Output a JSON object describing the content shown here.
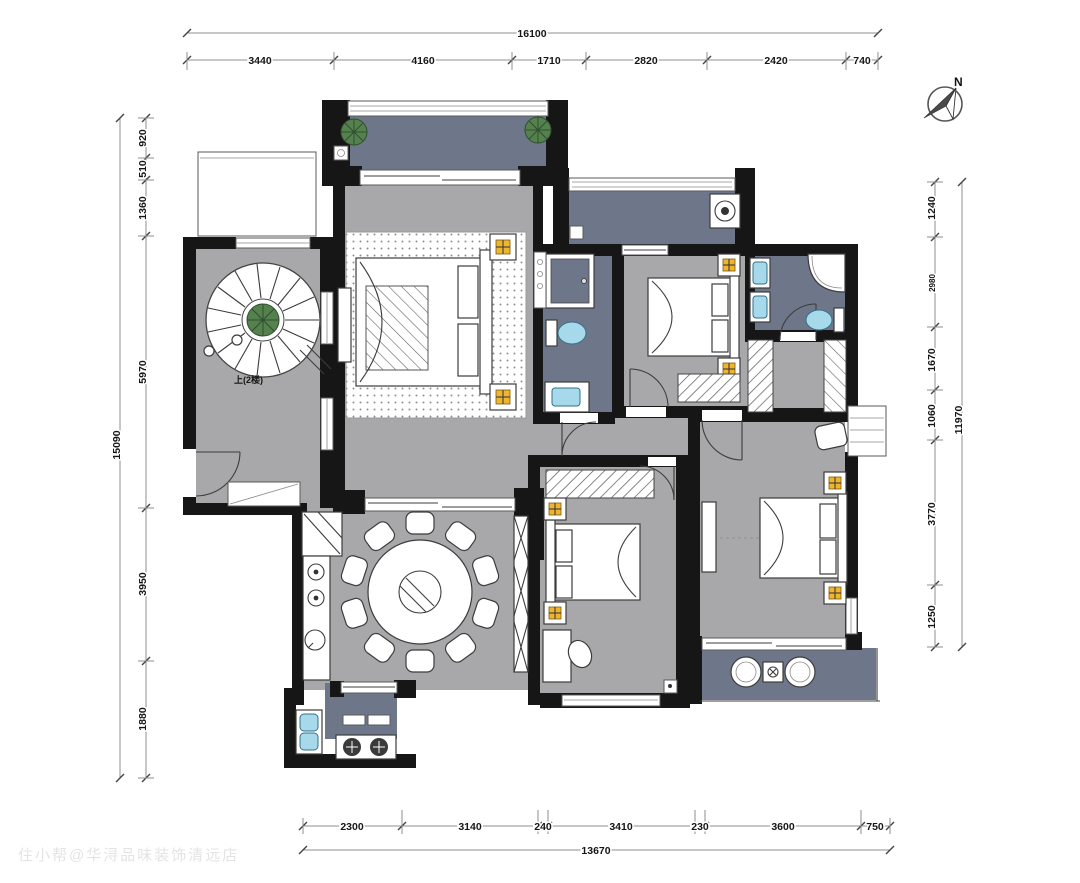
{
  "title": "residential-floor-plan",
  "north": {
    "label": "N"
  },
  "watermark": "住小帮@华浔品味装饰清远店",
  "stair_note": "上(2楼)",
  "colors": {
    "wall": "#161616",
    "floor": "#a8a8aa",
    "wet": "#6e7689",
    "lamp": "#f0b42d",
    "fixture": "#a6d9ea",
    "plant": "#55814f",
    "line": "#3c3c3c"
  },
  "dims": {
    "top": {
      "total": "16100",
      "segments": [
        "3440",
        "4160",
        "1710",
        "2820",
        "2420",
        "740"
      ]
    },
    "bottom": {
      "total": "13670",
      "segments": [
        "2300",
        "3140",
        "240",
        "3410",
        "230",
        "3600",
        "750"
      ]
    },
    "left": {
      "total": "15090",
      "segments": [
        "920",
        "510",
        "1360",
        "5970",
        "3950",
        "1880"
      ]
    },
    "right": {
      "total": "11970",
      "segments": [
        "1240",
        "2980",
        "1670",
        "1060",
        "3770",
        "1250"
      ]
    }
  }
}
